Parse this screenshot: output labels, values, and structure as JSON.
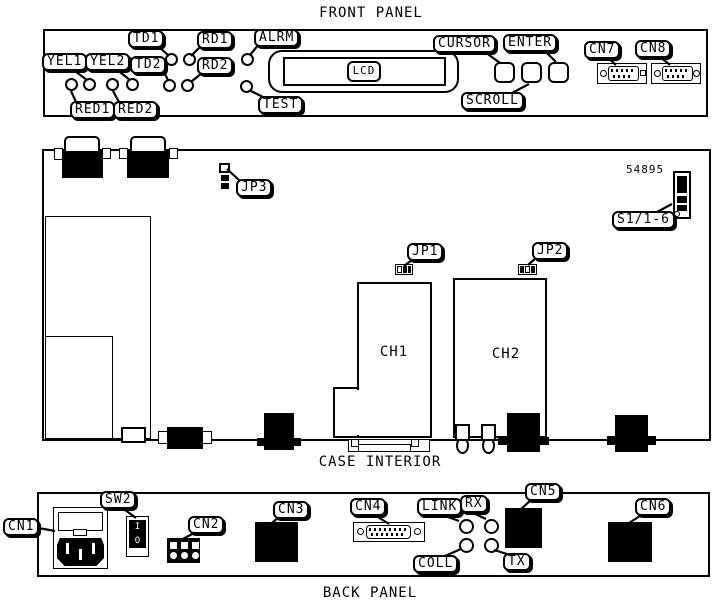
{
  "titles": {
    "front_panel": "FRONT PANEL",
    "case_interior": "CASE INTERIOR",
    "back_panel": "BACK PANEL"
  },
  "front_panel": {
    "led_labels": {
      "yel1": "YEL1",
      "yel2": "YEL2",
      "red1": "RED1",
      "red2": "RED2",
      "td1": "TD1",
      "td2": "TD2",
      "rd1": "RD1",
      "rd2": "RD2",
      "alrm": "ALRM",
      "test": "TEST"
    },
    "display_label": "LCD",
    "button_labels": {
      "cursor": "CURSOR",
      "enter": "ENTER",
      "scroll": "SCROLL"
    },
    "connector_labels": {
      "cn7": "CN7",
      "cn8": "CN8"
    }
  },
  "case_interior": {
    "jumper_labels": {
      "jp1": "JP1",
      "jp2": "JP2",
      "jp3": "JP3"
    },
    "channel_labels": {
      "ch1": "CH1",
      "ch2": "CH2"
    },
    "part_number": "54895",
    "dip_switch_label": "S1/1-6"
  },
  "back_panel": {
    "connector_labels": {
      "cn1": "CN1",
      "cn2": "CN2",
      "cn3": "CN3",
      "cn4": "CN4",
      "cn5": "CN5",
      "cn6": "CN6"
    },
    "switch_label": "SW2",
    "switch_markings": {
      "on": "I",
      "off": "O"
    },
    "led_labels": {
      "link": "LINK",
      "rx": "RX",
      "coll": "COLL",
      "tx": "TX"
    }
  },
  "colors": {
    "ink": "#000000",
    "paper": "#ffffff"
  }
}
